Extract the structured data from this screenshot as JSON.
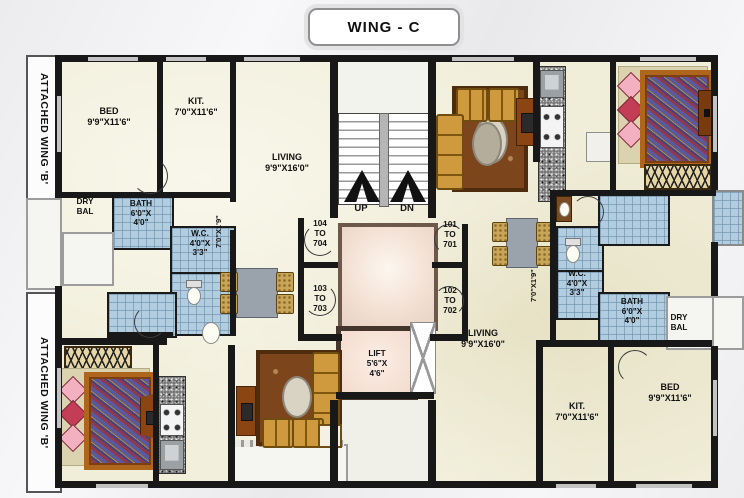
{
  "title": "WING - C",
  "wing_labels": {
    "top": "ATTACHED WING 'B'",
    "bottom": "ATTACHED WING 'B'"
  },
  "core": {
    "up": "UP",
    "dn": "DN",
    "lift": "LIFT\n5'6\"X\n4'6\"",
    "doors": {
      "d104": "104\nTO\n704",
      "d103": "103\nTO\n703",
      "d101": "101\nTO\n701",
      "d102": "102\nTO\n702"
    }
  },
  "flat_104": {
    "bed": "BED\n9'9\"X11'6\"",
    "kit": "KIT.\n7'0\"X11'6\"",
    "living": "LIVING\n9'9\"X16'0\"",
    "dry_bal": "DRY\nBAL",
    "bath": "BATH\n6'0\"X\n4'0\"",
    "wc": "W.C.\n4'0\"X\n3'3\"",
    "passage": "7'0\"X1'9\""
  },
  "flat_102": {
    "bed": "BED\n9'9\"X11'6\"",
    "kit": "KIT.\n7'0\"X11'6\"",
    "living": "LIVING\n9'9\"X16'0\"",
    "dry_bal": "DRY\nBAL",
    "bath": "BATH\n6'0\"X\n4'0\"",
    "wc": "W.C.\n4'0\"X\n3'3\"",
    "passage": "7'0\"X1'9\""
  },
  "colors": {
    "wall": "#181818",
    "bathroom_tile": "#b3cde0",
    "floor_marble": "#f0edd8",
    "lobby": "#f3e1d5",
    "lift_cabin": "#f3d9cb",
    "carpet": "#7c451c",
    "sofa": "#cf9a3e"
  }
}
